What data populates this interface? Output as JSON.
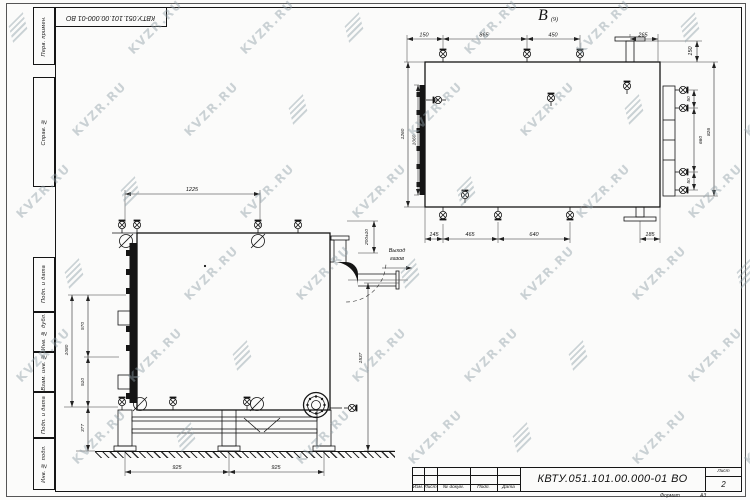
{
  "watermark": {
    "text": "KVZR.RU",
    "color": "#8fa0a8",
    "rows": 6,
    "cols": 7,
    "x0": 8,
    "y0": 20,
    "dx": 112,
    "dy": 82,
    "stagger": 56
  },
  "stamp_top": {
    "doc_number": "КВТУ.051.101.00.000-01 ВО"
  },
  "side_column": {
    "labels": [
      "Перв. примен.",
      "Справ. №",
      "Подп. и дата",
      "Инв. № дубл.",
      "Взам. инв. №",
      "Подп. и дата",
      "Инв. № подл."
    ]
  },
  "title_block": {
    "doc_number": "КВТУ.051.101.00.000-01 ВО",
    "columns": [
      "Изм.",
      "Лист",
      "№ докум.",
      "Подп.",
      "Дата"
    ],
    "sheet_label": "Лист",
    "sheet_number": "2",
    "format_label": "Формат",
    "format_value": "А3"
  },
  "top_view": {
    "label": "B",
    "label_sub": "(9)",
    "dims_top": [
      "150",
      "865",
      "450",
      "265"
    ],
    "dim_right_top": "150",
    "dims_right": [
      "50",
      "660",
      "50"
    ],
    "dim_right_outer": "826",
    "dims_left": [
      "1260",
      "1060"
    ],
    "dims_bottom": [
      "145",
      "465",
      "640",
      "185"
    ]
  },
  "front_view": {
    "dim_top": "1225",
    "dims_left": [
      "570",
      "510",
      "377"
    ],
    "dim_left_outer": "1080",
    "dim_flue": "200±10",
    "dim_height": "1537",
    "dims_bottom": [
      "925",
      "925"
    ],
    "flue_label_1": "Выход",
    "flue_label_2": "газов"
  }
}
